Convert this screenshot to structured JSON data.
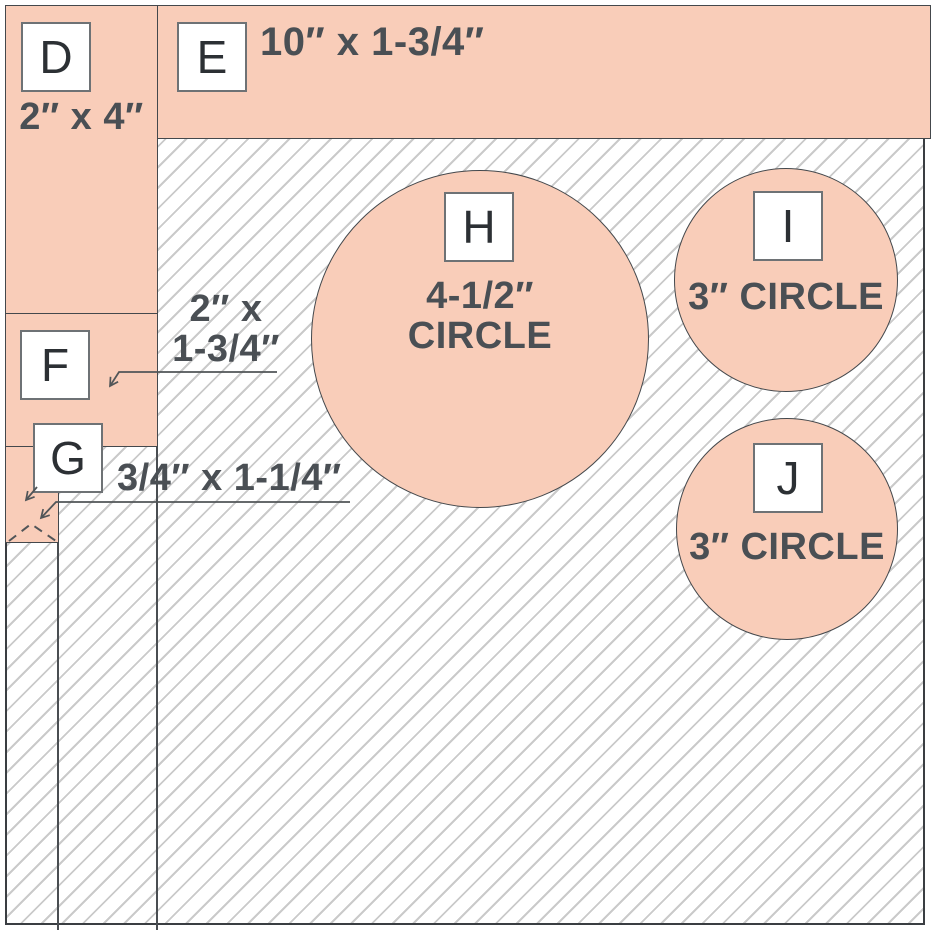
{
  "diagram": {
    "kind": "cutting-layout",
    "pieces": {
      "d": {
        "label": "D",
        "dimension": "2″ x 4″",
        "shape": "rectangle"
      },
      "e": {
        "label": "E",
        "dimension": "10″ x 1-3/4″",
        "shape": "rectangle"
      },
      "f": {
        "label": "F",
        "dimension_line1": "2″ x",
        "dimension_line2": "1-3/4″",
        "shape": "rectangle"
      },
      "g": {
        "label": "G",
        "dimension": "3/4″ x 1-1/4″",
        "shape": "rectangle"
      },
      "h": {
        "label": "H",
        "dimension_line1": "4-1/2″",
        "dimension_line2": "CIRCLE",
        "shape": "circle"
      },
      "i": {
        "label": "I",
        "dimension": "3″ CIRCLE",
        "shape": "circle"
      },
      "j": {
        "label": "J",
        "dimension": "3″ CIRCLE",
        "shape": "circle"
      }
    },
    "colors": {
      "piece_fill": "#f9cdb9",
      "piece_outline": "#44484c",
      "hatch_line": "#cacaca",
      "frame_border": "#3a3e42",
      "dimension_text": "#4a4f54",
      "label_text": "#2c3034",
      "label_border": "#6e7275",
      "leader_line": "#515558"
    }
  }
}
